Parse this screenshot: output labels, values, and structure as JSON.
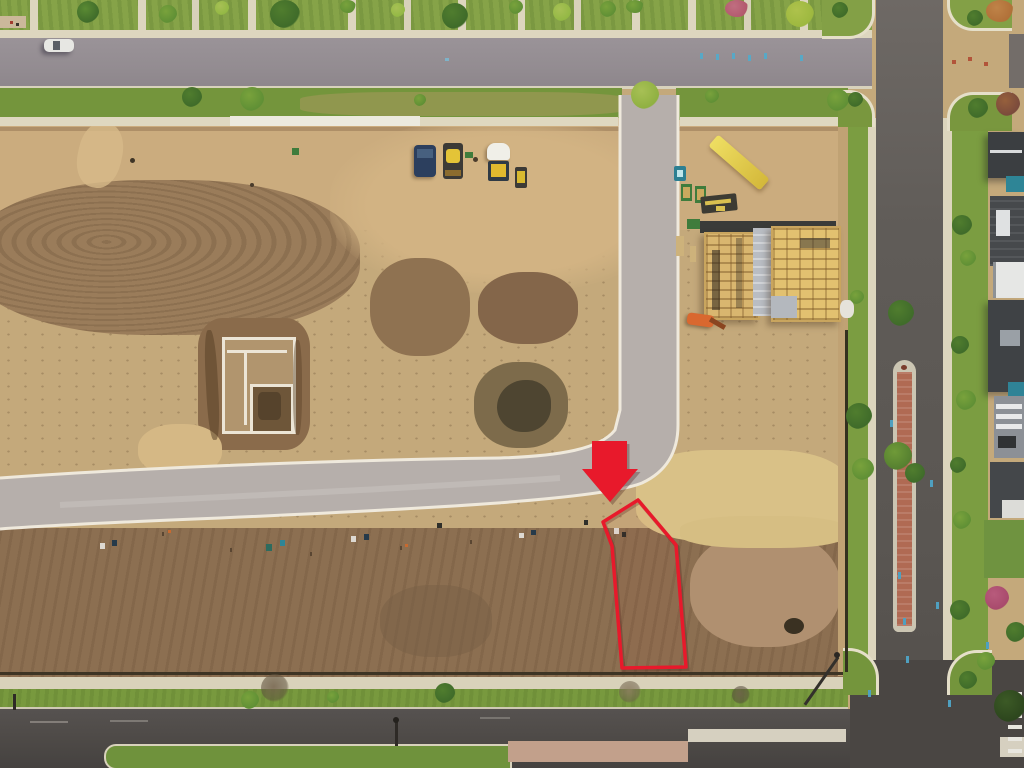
{
  "scene": {
    "type": "aerial-drone-photo",
    "description": "Overhead view of a residential subdivision under construction: graded dirt lots, a curved new road, construction vehicles, a poured foundation, two wood-framed houses, finished townhomes along the right street, and a vacant lot marked for sale",
    "marker": "A red arrow points down at a vacant lot outlined in red at the corner of the curved road"
  },
  "palette": {
    "red": "#e8192b",
    "grass": "#7b9d41",
    "grassDark": "#6f923c",
    "treeDark": "#3f6b2a",
    "treeMid": "#5f8f35",
    "treeBright": "#93b844",
    "sidewalk": "#ddd6bf",
    "curb": "#efe9dc",
    "roadTop": "#938c91",
    "roadLight": "#b6afab",
    "roadDark": "#5e5a56",
    "roadBottom": "#4e4a47",
    "dirtLight": "#c9ab7d",
    "dirtMid": "#b29270",
    "dirtDark": "#8c6f51",
    "sand": "#d9c187",
    "brickMedian": "#b06a53",
    "teal": "#2e8596",
    "dumpsterGreen": "#3f7c3c",
    "machineYellow": "#e4c437",
    "machineNavy": "#2c3f5e",
    "machineOrange": "#d9682f",
    "foundationWhite": "#ece5d6"
  },
  "annotations": {
    "arrow": {
      "label": "red-arrow-marker",
      "points": "592,441 627,441 627,469 638,469 610,502 582,469 592,469",
      "color": "#e8192b"
    },
    "lot_outline": {
      "label": "highlighted-vacant-lot",
      "points": "638,500 676,545 686,667 622,668 612,546 603,522",
      "color": "#e8192b"
    }
  },
  "objects": {
    "vehicles": [
      "navy-bulldozer",
      "yellow-dozer",
      "white-yellow-truck",
      "yellow-compact-loader",
      "orange-telehandler",
      "white-parked-car"
    ],
    "site_items": [
      "concrete-foundation-forms",
      "excavation-puddle",
      "porta-potty",
      "green-dumpsters",
      "lumber-pile-yellow",
      "equipment-trailer",
      "silt-fence",
      "utility-boxes",
      "survey-stakes"
    ],
    "structures": [
      "framed-house-left",
      "framed-house-right",
      "townhome-row-right"
    ],
    "roads": [
      "top-street",
      "curved-new-road",
      "right-street-with-brick-median",
      "bottom-street",
      "intersection-top",
      "intersection-bottom",
      "crosswalk-bars"
    ]
  }
}
